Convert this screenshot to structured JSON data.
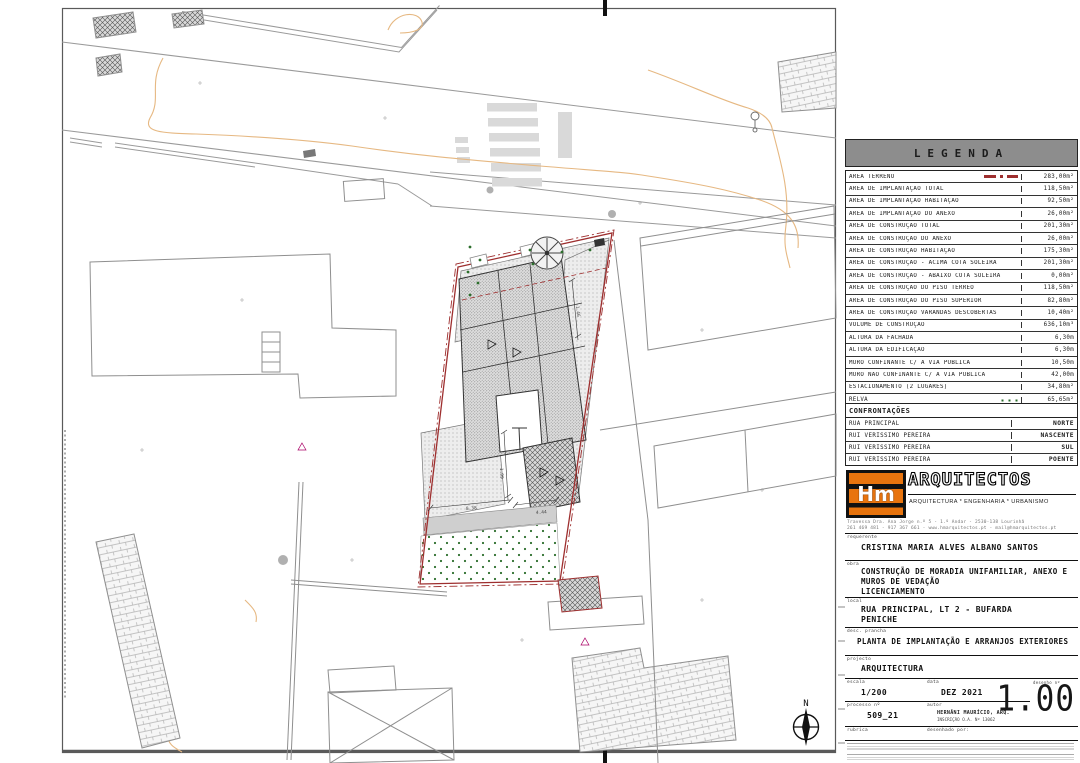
{
  "legend": {
    "title": "LEGENDA",
    "rows": [
      {
        "label": "ÁREA TERRENO",
        "value": "283,00m²",
        "symbol": "terreno"
      },
      {
        "label": "ÁREA DE IMPLANTAÇÃO TOTAL",
        "value": "118,50m²",
        "symbol": ""
      },
      {
        "label": "ÁREA DE IMPLANTAÇÃO HABITAÇÃO",
        "value": "92,50m²",
        "symbol": ""
      },
      {
        "label": "ÁREA DE IMPLANTAÇÃO DO ANEXO",
        "value": "26,00m²",
        "symbol": ""
      },
      {
        "label": "ÁREA DE CONSTRUÇÃO TOTAL",
        "value": "201,30m²",
        "symbol": ""
      },
      {
        "label": "ÁREA DE CONSTRUÇÃO DO ANEXO",
        "value": "26,00m²",
        "symbol": ""
      },
      {
        "label": "ÁREA DE CONSTRUÇÃO HABITAÇÃO",
        "value": "175,30m²",
        "symbol": ""
      },
      {
        "label": "ÁREA DE CONSTRUÇÃO - ACIMA COTA SOLEIRA",
        "value": "201,30m²",
        "symbol": ""
      },
      {
        "label": "ÁREA DE CONSTRUÇÃO - ABAIXO COTA SOLEIRA",
        "value": "0,00m²",
        "symbol": ""
      },
      {
        "label": "ÁREA DE CONSTRUÇÃO DO PISO TÉRREO",
        "value": "118,50m²",
        "symbol": ""
      },
      {
        "label": "ÁREA DE CONSTRUÇÃO DO PISO SUPERIOR",
        "value": "82,80m²",
        "symbol": ""
      },
      {
        "label": "ÁREA DE CONSTRUÇÃO VARANDAS DESCOBERTAS",
        "value": "10,40m²",
        "symbol": ""
      },
      {
        "label": "VOLUME DE CONSTRUÇÃO",
        "value": "636,10m³",
        "symbol": ""
      },
      {
        "label": "ALTURA DA FACHADA",
        "value": "6,30m",
        "symbol": ""
      },
      {
        "label": "ALTURA DA EDIFICAÇÃO",
        "value": "6,30m",
        "symbol": ""
      },
      {
        "label": "MURO CONFINANTE C/ A VIA PÚBLICA",
        "value": "10,50m",
        "symbol": ""
      },
      {
        "label": "MURO NÃO CONFINANTE C/ A VIA PÚBLICA",
        "value": "42,00m",
        "symbol": ""
      },
      {
        "label": "ESTACIONAMENTO (2 LUGARES)",
        "value": "34,80m²",
        "symbol": ""
      },
      {
        "label": "RELVA",
        "value": "65,65m²",
        "symbol": "relva"
      },
      {
        "label": "PAVÊ",
        "value": "96,60m²",
        "symbol": "pave"
      }
    ]
  },
  "confrontacoes": {
    "title": "CONFRONTAÇÕES",
    "rows": [
      {
        "name": "RUA PRINCIPAL",
        "direction": "NORTE"
      },
      {
        "name": "RUI VERISSIMO PEREIRA",
        "direction": "NASCENTE"
      },
      {
        "name": "RUI VERISSIMO PEREIRA",
        "direction": "SUL"
      },
      {
        "name": "RUI VERISSIMO PEREIRA",
        "direction": "POENTE"
      }
    ]
  },
  "firm": {
    "logo_text": "Hm",
    "name": "ARQUITECTOS",
    "tagline": "ARQUITECTURA * ENGENHARIA * URBANISMO",
    "address_line1": "Travessa Dra. Ana Jorge n.º 5 - 1.º Andar - 2530-138 Lourinhã",
    "address_line2": "261 469 481 - 917 367 661 - www.hmarquitectos.pt - mail@hmarquitectos.pt"
  },
  "titleblock": {
    "requerente_label": "requerente",
    "requerente": "CRISTINA MARIA ALVES ALBANO SANTOS",
    "obra_label": "obra",
    "obra_line1": "CONSTRUÇÃO DE MORADIA UNIFAMILIAR, ANEXO E",
    "obra_line2": "MUROS DE VEDAÇÃO",
    "obra_line3": "LICENCIAMENTO",
    "local_label": "local",
    "local_line1": "RUA PRINCIPAL, LT 2 - BUFARDA",
    "local_line2": "PENICHE",
    "prancha_label": "desc. prancha",
    "prancha": "PLANTA DE IMPLANTAÇÃO E ARRANJOS EXTERIORES",
    "projecto_label": "projecto",
    "projecto": "ARQUITECTURA",
    "escala_label": "escala",
    "escala": "1/200",
    "data_label": "data",
    "data": "DEZ 2021",
    "desenho_label": "desenho nº",
    "desenho": "1.00",
    "processo_label": "processo nº",
    "processo": "509_21",
    "autor_label": "autor",
    "autor_line1": "HERNÂNI MAURÍCIO, ARQ.",
    "autor_line2": "INSCRIÇÃO O.A. Nº 13062",
    "rubrica_label": "rubrica",
    "desenhado_label": "desenhado por:"
  },
  "plan": {
    "north_label": "N",
    "dim_labels": [
      {
        "x": 466,
        "y": 510,
        "rot": -4,
        "text": "8.38"
      },
      {
        "x": 536,
        "y": 514,
        "rot": -4,
        "text": "4.44"
      },
      {
        "x": 500,
        "y": 468,
        "rot": 87,
        "text": "1.99"
      },
      {
        "x": 576,
        "y": 306,
        "rot": 84,
        "text": "1.46"
      }
    ],
    "colors": {
      "lot_boundary": "#9e2f2f",
      "grass": "#2c6e2c",
      "contour": "#e6b882",
      "logo_orange": "#e8740e"
    }
  }
}
